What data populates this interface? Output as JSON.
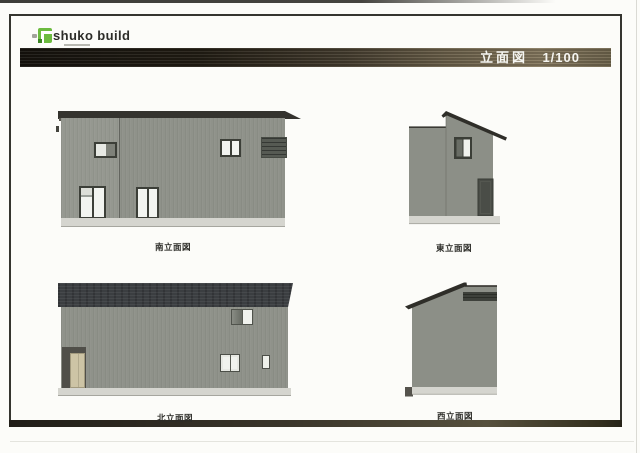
{
  "logo": {
    "brand": "shuko build",
    "icon": "shuko-build-green-square-logo"
  },
  "title_block": {
    "title": "立面図",
    "scale": "1/100"
  },
  "elevations": [
    {
      "name": "south",
      "label": "南立面図"
    },
    {
      "name": "east",
      "label": "東立面図"
    },
    {
      "name": "north",
      "label": "北立面図"
    },
    {
      "name": "west",
      "label": "西立面図"
    }
  ],
  "colors": {
    "facade_gray": "#8f928a",
    "roof_dark": "#34332e",
    "north_roof_charcoal": "#3b3e41",
    "foundation_gray": "#d5d5cf",
    "glazing_white": "#f2f4f0",
    "window_frame": "#3c3f38",
    "door_tan": "#cdc4a5",
    "logo_green": "#6cbb3f",
    "title_bar_wood": "#6b604a",
    "title_text": "#f5f5f1"
  }
}
